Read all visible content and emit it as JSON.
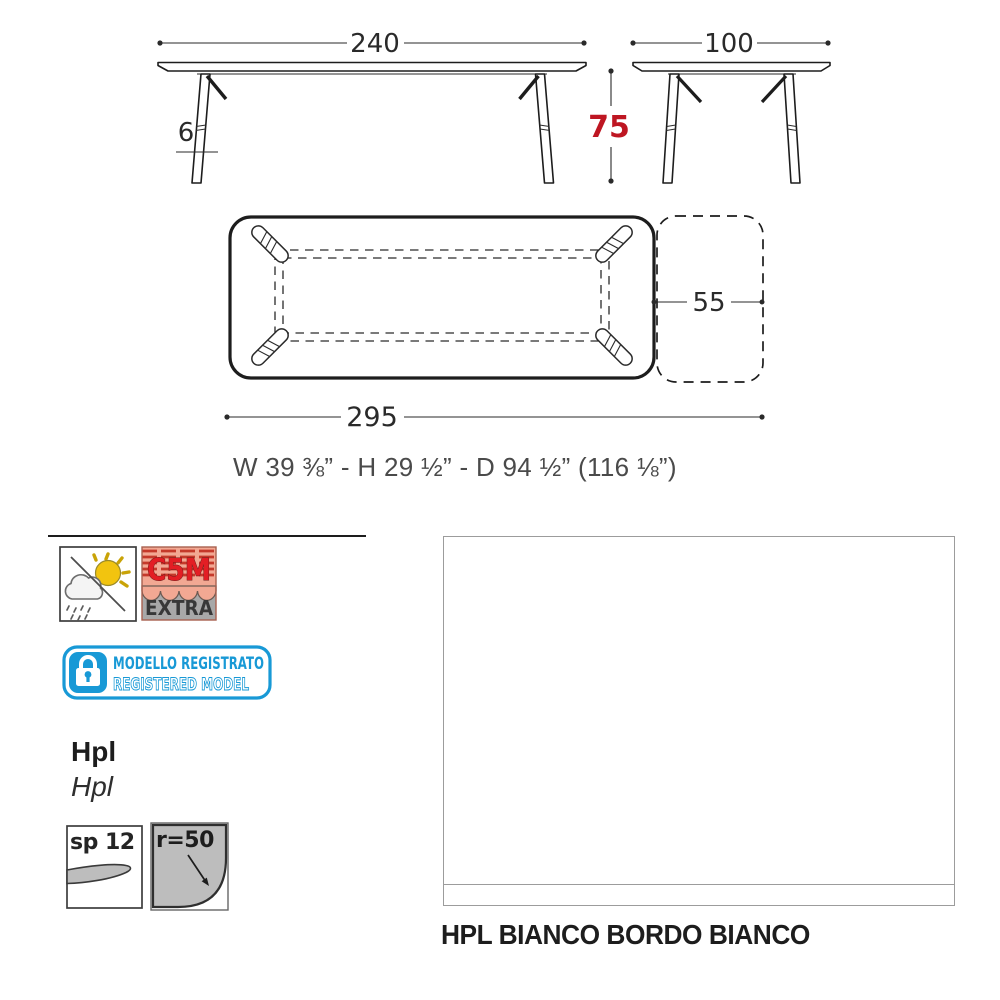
{
  "front_view": {
    "width": "240",
    "leg_thickness": "6"
  },
  "side_view": {
    "depth": "100",
    "height": "75"
  },
  "plan_view": {
    "total_length": "295",
    "extension_depth": "55"
  },
  "imperial_dimensions": "W 39 ⅜” - H 29 ½”  - D 94 ½” (116 ⅛”)",
  "badges": {
    "c5m": {
      "title": "C5M",
      "subtitle": "EXTRA"
    },
    "registered": {
      "line1": "MODELLO REGISTRATO",
      "line2": "REGISTERED MODEL"
    }
  },
  "material": {
    "name": "Hpl",
    "name_secondary": "Hpl",
    "thickness": "sp 12",
    "corner_radius": "r=50"
  },
  "finish": {
    "caption": "HPL BIANCO BORDO BIANCO"
  },
  "colors": {
    "dimension_red": "#be1622",
    "badge_blue": "#1899d6",
    "c5m_red": "#e31e24",
    "salmon": "#f2a893",
    "swatch_border_gray": "#9c9c9c",
    "line_dark": "#1d1d1d"
  }
}
